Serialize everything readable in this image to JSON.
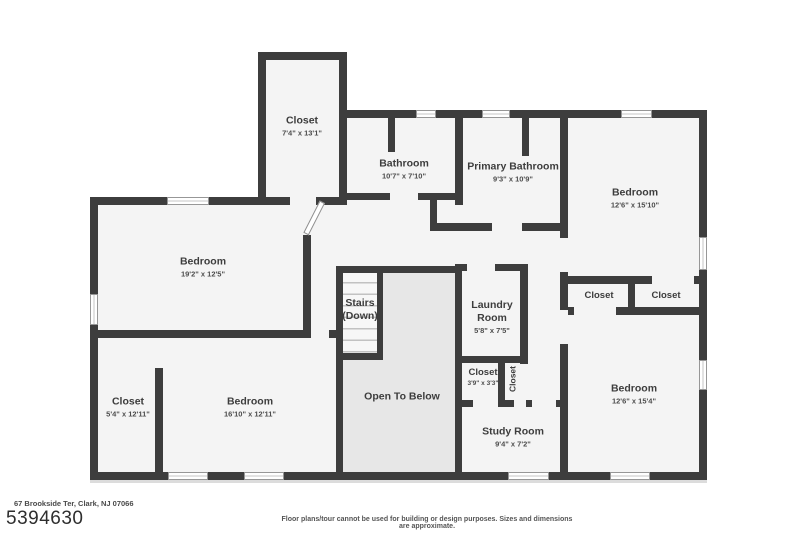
{
  "floor_plan": {
    "address": "67 Brookside Ter, Clark, NJ 07066",
    "listing_id": "5394630",
    "disclaimer": "Floor plans/tour cannot be used for building or design purposes. Sizes and dimensions are approximate.",
    "rooms": [
      {
        "name": "Closet",
        "dims": "7'4\" x 13'1\""
      },
      {
        "name": "Bathroom",
        "dims": "10'7\" x 7'10\""
      },
      {
        "name": "Primary Bathroom",
        "dims": "9'3\" x 10'9\""
      },
      {
        "name": "Bedroom",
        "dims": "12'6\" x 15'10\""
      },
      {
        "name": "Bedroom",
        "dims": "19'2\" x 12'5\""
      },
      {
        "name": "Stairs",
        "dims": "(Down)"
      },
      {
        "name": "Laundry Room",
        "dims": "5'8\" x 7'5\""
      },
      {
        "name": "Closet",
        "dims": ""
      },
      {
        "name": "Closet",
        "dims": ""
      },
      {
        "name": "Closet",
        "dims": "3'9\" x 3'3\""
      },
      {
        "name": "Closet",
        "dims": ""
      },
      {
        "name": "Open To Below",
        "dims": ""
      },
      {
        "name": "Closet",
        "dims": "5'4\" x 12'11\""
      },
      {
        "name": "Bedroom",
        "dims": "16'10\" x 12'11\""
      },
      {
        "name": "Study Room",
        "dims": "9'4\" x 7'2\""
      },
      {
        "name": "Bedroom",
        "dims": "12'6\" x 15'4\""
      }
    ]
  }
}
